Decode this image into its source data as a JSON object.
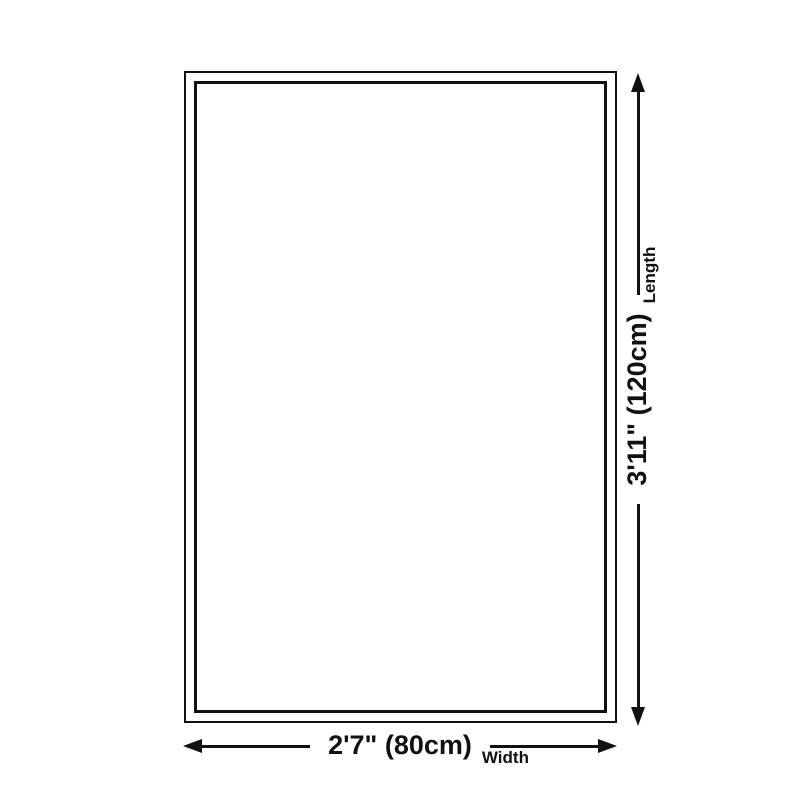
{
  "diagram": {
    "dimensions": {
      "width": {
        "value": "2'7\" (80cm)",
        "label": "Width"
      },
      "length": {
        "value": "3'11\" (120cm)",
        "label": "Length"
      }
    },
    "colors": {
      "line": "#111111",
      "background": "#ffffff"
    }
  }
}
